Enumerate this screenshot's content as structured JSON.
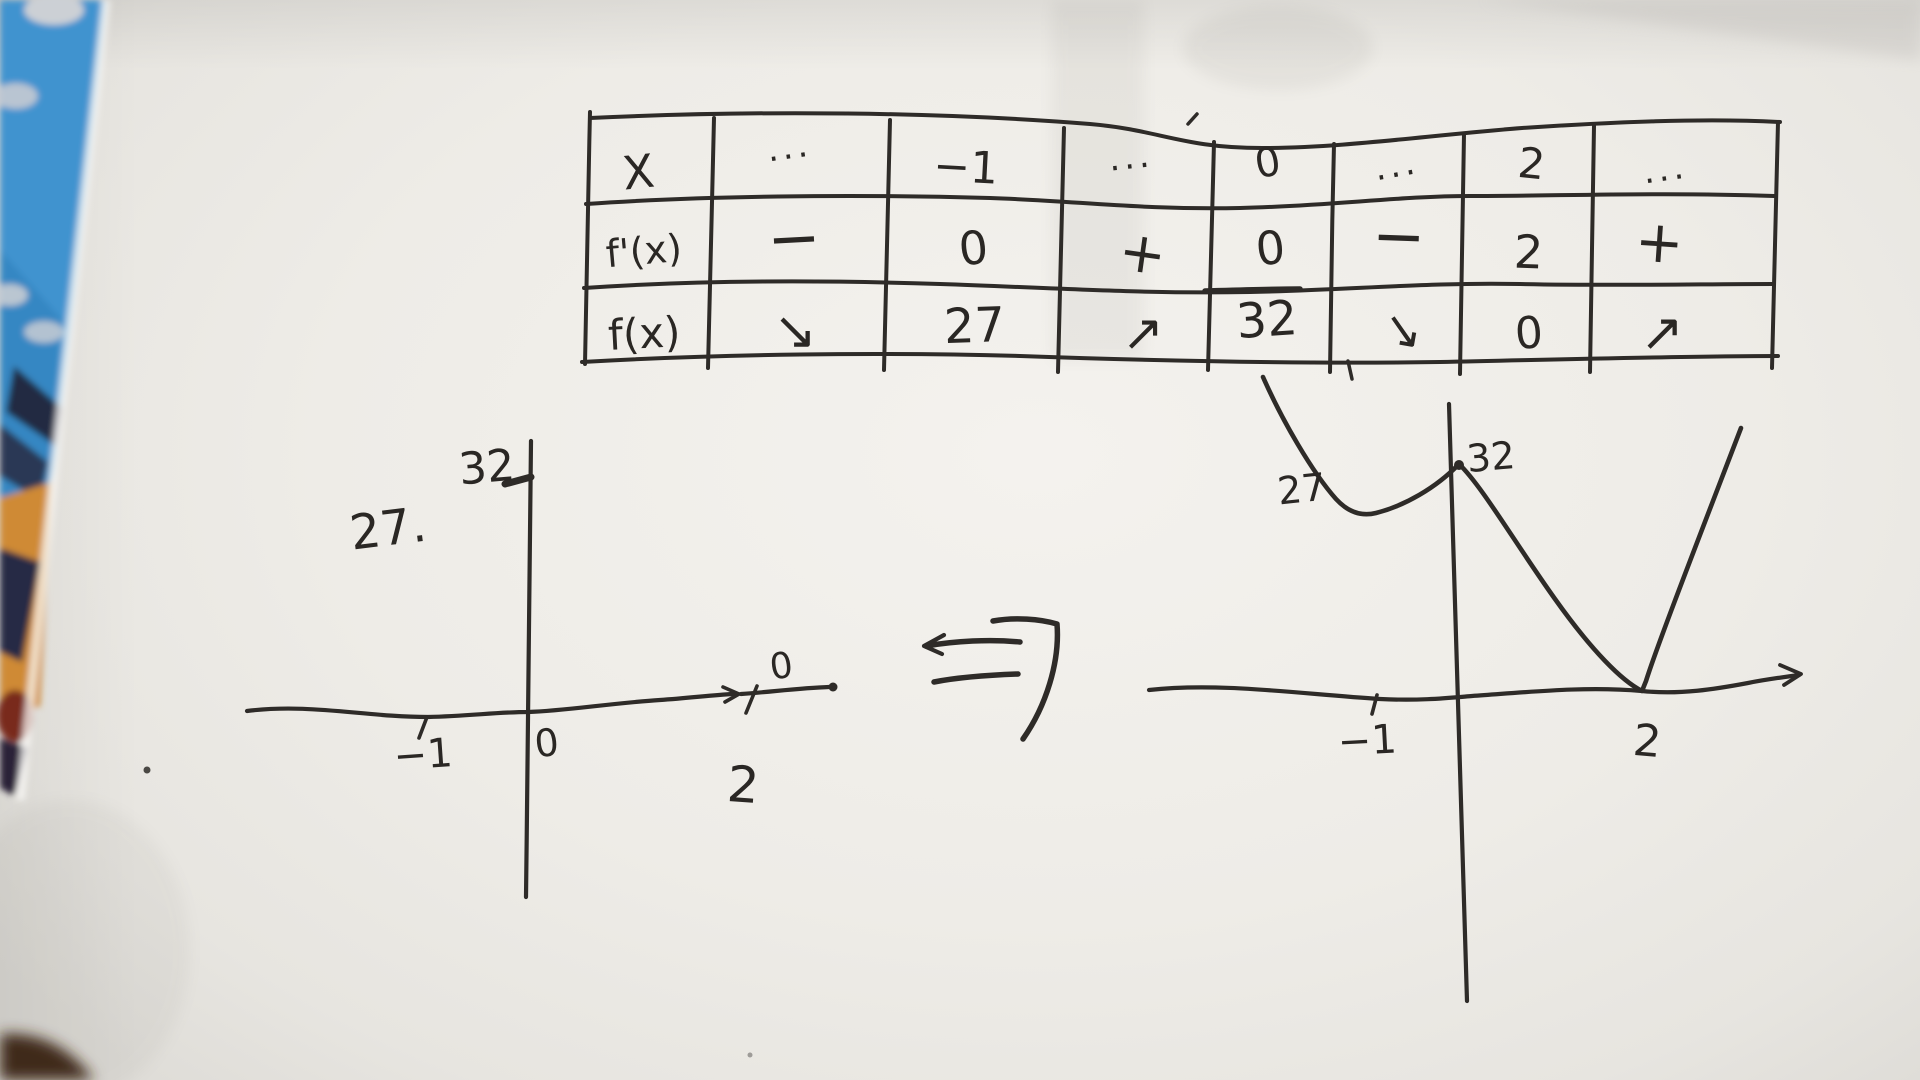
{
  "colors": {
    "ink": "#2e2b28",
    "paper": "#efede8",
    "fabric_blue": "#3f93cf",
    "fabric_cloud": "#ccd0d5",
    "fabric_navy": "#242a42",
    "fabric_orange": "#cf8a35",
    "fabric_maroon": "#79291f",
    "corner_brown": "#3d2719"
  },
  "table": {
    "rows": [
      {
        "label": "X",
        "cells": [
          "···",
          "−1",
          "···",
          "0",
          "···",
          "2",
          "···"
        ]
      },
      {
        "label": "f'(x)",
        "cells": [
          "−",
          "0",
          "+",
          "0",
          "−",
          "2",
          "+"
        ]
      },
      {
        "label": "f(x)",
        "cells": [
          "↘",
          "27",
          "↗",
          "32",
          "↘",
          "0",
          "↗"
        ]
      }
    ]
  },
  "left_graph": {
    "y_tick_label": "32",
    "side_label": "27.",
    "x_tick_label_neg1": "−1",
    "origin_label": "0",
    "x_tick_label_2": "2",
    "zero_above_axis_label": "0"
  },
  "implies_arrow": {
    "symbol": "⇒"
  },
  "right_graph": {
    "local_min_label": "27",
    "local_max_label": "32",
    "x_tick_label_neg1": "−1",
    "x_tick_label_2": "2"
  }
}
